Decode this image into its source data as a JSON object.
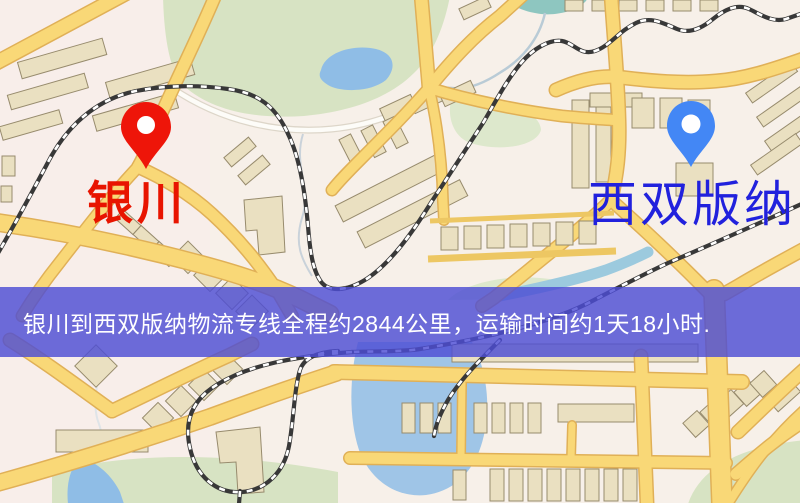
{
  "route_banner": {
    "text": "银川到西双版纳物流专线全程约2844公里，运输时间约1天18小时.",
    "origin": "银川",
    "destination": "西双版纳",
    "distance_text": "约2844公里",
    "duration_text": "约1天18小时",
    "text_color": "#ffffff",
    "overlay_color": "#4d4dd4"
  },
  "markers": {
    "origin": {
      "label": "银川",
      "pin_color": "#ee1509",
      "label_color": "#e81400"
    },
    "destination": {
      "label": "西双版纳",
      "pin_color": "#4387f5",
      "label_color": "#2121dd"
    }
  },
  "map_palette": {
    "background": "#f7f0e9",
    "road_fill": "#f9d877",
    "road_casing": "#e0b057",
    "park_green": "#d7e3c3",
    "water_blue": "#8fbde6",
    "building_tan": "#eae0c1",
    "railway_dark": "#383838"
  }
}
